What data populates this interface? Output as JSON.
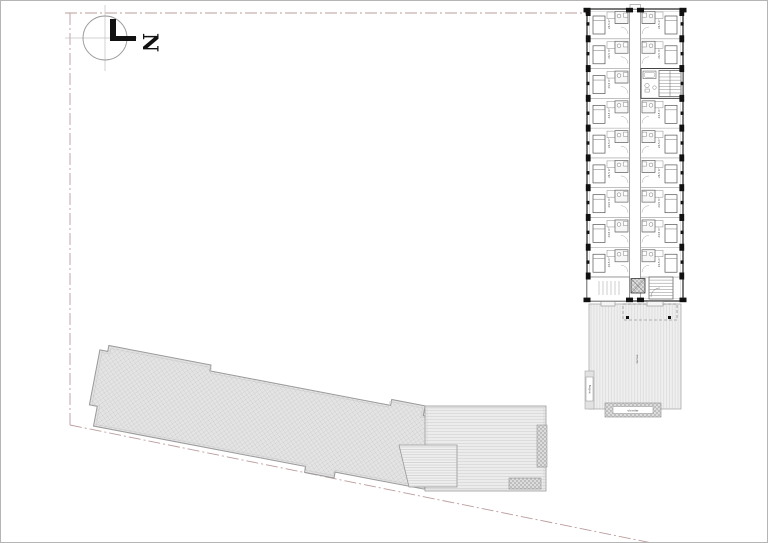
{
  "page": {
    "w": 768,
    "h": 543,
    "frame_color": "#b5b5b5",
    "background": "#ffffff"
  },
  "north": {
    "letter": "N",
    "cx": 104,
    "cy": 37,
    "r": 22,
    "label_x": 152,
    "label_y": 44
  },
  "colors": {
    "boundary": "#bb9d9d",
    "wall_dark": "#333333",
    "pier_black": "#111111",
    "line_mid": "#808080",
    "line_light": "#c0c0c0",
    "roof_fill": "#e4e4e4",
    "roof_hatch": "#cdcdcd",
    "deck_fill": "#ececec",
    "deck_hatch": "#d2d2d2",
    "ramp_fill": "#f0f0f0",
    "ramp_hatch": "#c6c6c6",
    "terrace_fill": "#efefef",
    "terrace_hatch": "#d9d9d9",
    "pad_fill": "#dcdcdc",
    "pad_hatch": "#a0a0a0"
  },
  "boundary": {
    "top": [
      [
        64,
        12
      ],
      [
        586,
        12
      ]
    ],
    "left": [
      [
        69,
        12
      ],
      [
        69,
        424
      ]
    ],
    "diagonal": [
      [
        69,
        424
      ],
      [
        656,
        543
      ]
    ],
    "dash": "12 3 2 3"
  },
  "building": {
    "x": 586,
    "y": 8,
    "w": 96,
    "h": 292,
    "rows": 9,
    "row_pitch": 29.78,
    "units_end_y": 276,
    "corridor_x1": 628.5,
    "corridor_x2": 639.5,
    "core_row_right": 2,
    "unit_label": "24,5 m²"
  },
  "roof": {
    "x": 100,
    "y": 343,
    "angle": 10.8,
    "path": "M0,6 H8 V0 H112 V6 H296 V0 H330 V10 H345 V82 H254 V88 H224 V82 H8 V62 H0 Z"
  },
  "deck": {
    "x": 424,
    "y": 405,
    "w": 121,
    "h": 85,
    "strip": {
      "x": 536,
      "y": 424,
      "w": 10,
      "h": 42
    },
    "pad": {
      "x": 508,
      "y": 477,
      "w": 32,
      "h": 11
    },
    "ramp_path": "M398,444 L456,444 L456,486 L408,486 Z"
  },
  "terrace": {
    "x": 588,
    "y": 303,
    "w": 92,
    "h": 105,
    "canopy": {
      "x": 622,
      "y": 303,
      "w": 54,
      "h": 16
    },
    "posts": [
      [
        625,
        315
      ],
      [
        667,
        315
      ]
    ],
    "label": "terras",
    "label_x": 637,
    "label_y": 358,
    "strip": {
      "x": 584,
      "y": 370,
      "w": 9,
      "h": 38,
      "label": "helling"
    },
    "pad": {
      "x": 604,
      "y": 402,
      "w": 56,
      "h": 14,
      "label": "vlonder"
    }
  }
}
